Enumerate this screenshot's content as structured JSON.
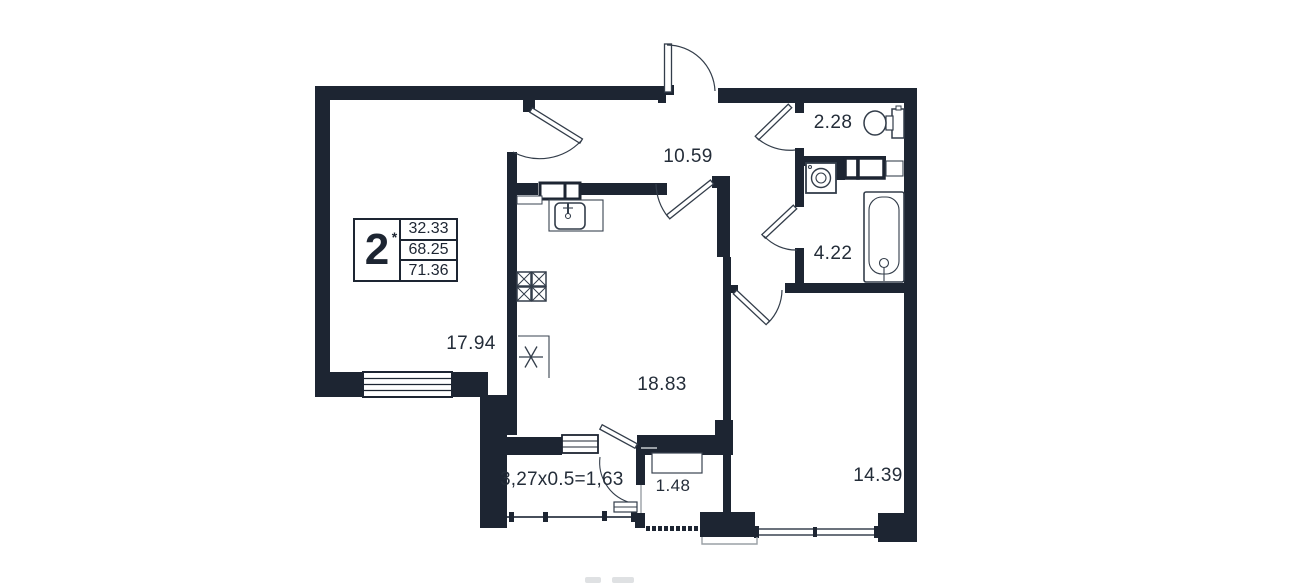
{
  "plan": {
    "legend": {
      "rooms": "2",
      "note_mark": "*",
      "values": [
        "32.33",
        "68.25",
        "71.36"
      ]
    },
    "labels": {
      "hallway": "10.59",
      "wc": "2.28",
      "bathroom": "4.22",
      "living_room": "17.94",
      "kitchen": "18.83",
      "bedroom": "14.39",
      "loggia": "1.48",
      "balcony_formula": "3,27x0.5=1,63"
    },
    "colors": {
      "wall": "#1d2532",
      "line": "#333d4a",
      "muted": "#9aa0a6"
    }
  }
}
